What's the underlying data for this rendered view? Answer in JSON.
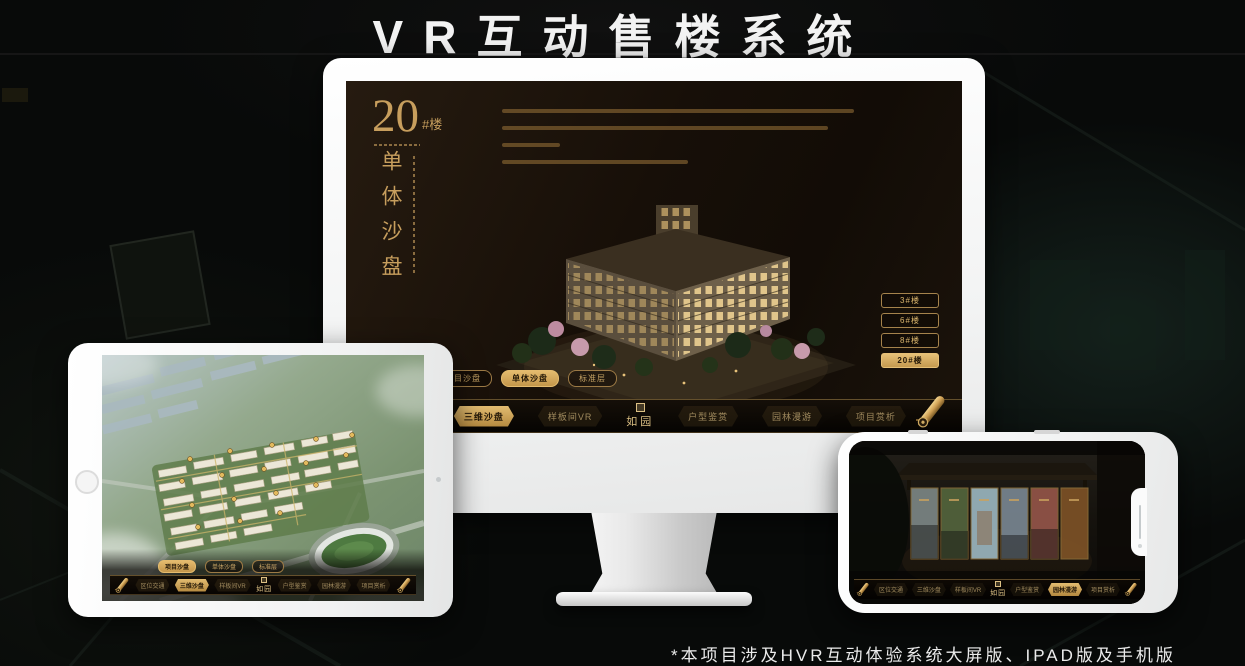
{
  "page": {
    "title": "VR互动售楼系统",
    "footnote": "*本项目涉及HVR互动体验系统大屏版、IPAD版及手机版"
  },
  "colors": {
    "gold": "#c9a15e",
    "gold_bright": "#e2bb70",
    "screen_bg": "#170f08"
  },
  "app": {
    "logo": {
      "name": "如园"
    },
    "view_tabs": [
      {
        "label": "项目沙盘"
      },
      {
        "label": "单体沙盘"
      },
      {
        "label": "标准层"
      }
    ],
    "nav_items": [
      {
        "label": "区位交通"
      },
      {
        "label": "三维沙盘"
      },
      {
        "label": "样板间VR"
      },
      {
        "label": "户型鉴赏"
      },
      {
        "label": "园林漫游"
      },
      {
        "label": "项目赏析"
      }
    ]
  },
  "monitor": {
    "headline": {
      "number": "20",
      "unit": "#楼",
      "vertical_title": "单体沙盘"
    },
    "floor_buttons": [
      {
        "label": "3#楼"
      },
      {
        "label": "6#楼"
      },
      {
        "label": "8#楼"
      },
      {
        "label": "20#楼"
      }
    ],
    "active_floor": "20#楼",
    "active_view_tab": "单体沙盘",
    "active_nav_item": "三维沙盘"
  },
  "tablet": {
    "active_view_tab": "项目沙盘",
    "active_nav_item": "三维沙盘"
  },
  "phone": {
    "active_nav_item": "园林漫游"
  }
}
